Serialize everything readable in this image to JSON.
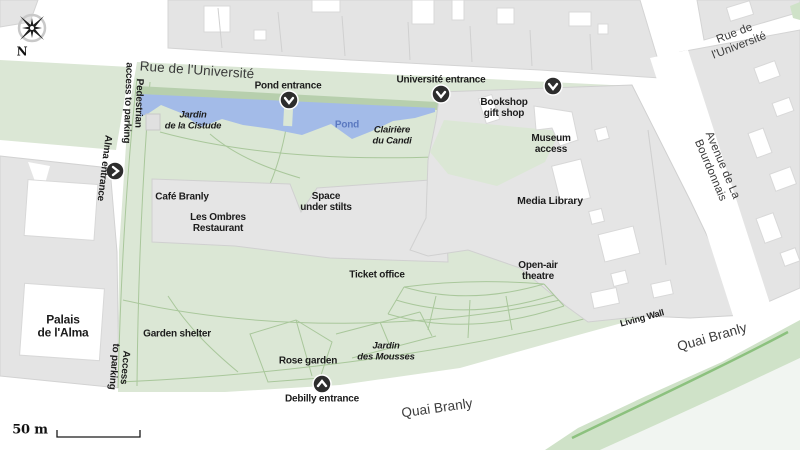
{
  "streets": {
    "rue_universite_top": "Rue de l'Université",
    "rue_universite_right": "Rue de l'Université",
    "avenue_bourdonnais": "Avenue de La Bourdonnais",
    "quai_branly_bottom": "Quai Branly",
    "quai_branly_right": "Quai Branly"
  },
  "entrances": {
    "pond": "Pond entrance",
    "universite": "Université entrance",
    "alma": "Alma entrance",
    "debilly": "Debilly entrance"
  },
  "access": {
    "pedestrian": "Pedestrian\naccess to parking",
    "parking": "Access\nto parking"
  },
  "buildings": {
    "cafe_branly": "Café Branly",
    "les_ombres": "Les Ombres\nRestaurant",
    "space_under_stilts": "Space\nunder stilts",
    "media_library": "Media Library",
    "bookshop": "Bookshop\ngift shop",
    "museum_access": "Museum\naccess",
    "ticket_office": "Ticket office",
    "palais_alma": "Palais\nde l'Alma"
  },
  "garden": {
    "jardin_cistude": "Jardin\nde la Cistude",
    "clairiere_candi": "Clairière\ndu Candi",
    "pond": "Pond",
    "open_air_theatre": "Open-air\ntheatre",
    "garden_shelter": "Garden shelter",
    "rose_garden": "Rose garden",
    "jardin_mousses": "Jardin\ndes Mousses",
    "living_wall": "Living Wall"
  },
  "map_elements": {
    "compass_n": "N",
    "scale": "50 m"
  },
  "colors": {
    "park_green": "#dbe7d5",
    "hedge_green": "#b7cfad",
    "pond_blue": "#a3bbe8",
    "pond_text": "#5b79c0",
    "building_gray": "#e4e4e4",
    "river_bank_green": "#cfe2c8",
    "tree_line_green": "#8cc17e",
    "seine": "#f1f5f1",
    "marker_dark": "#2d2d2d"
  }
}
